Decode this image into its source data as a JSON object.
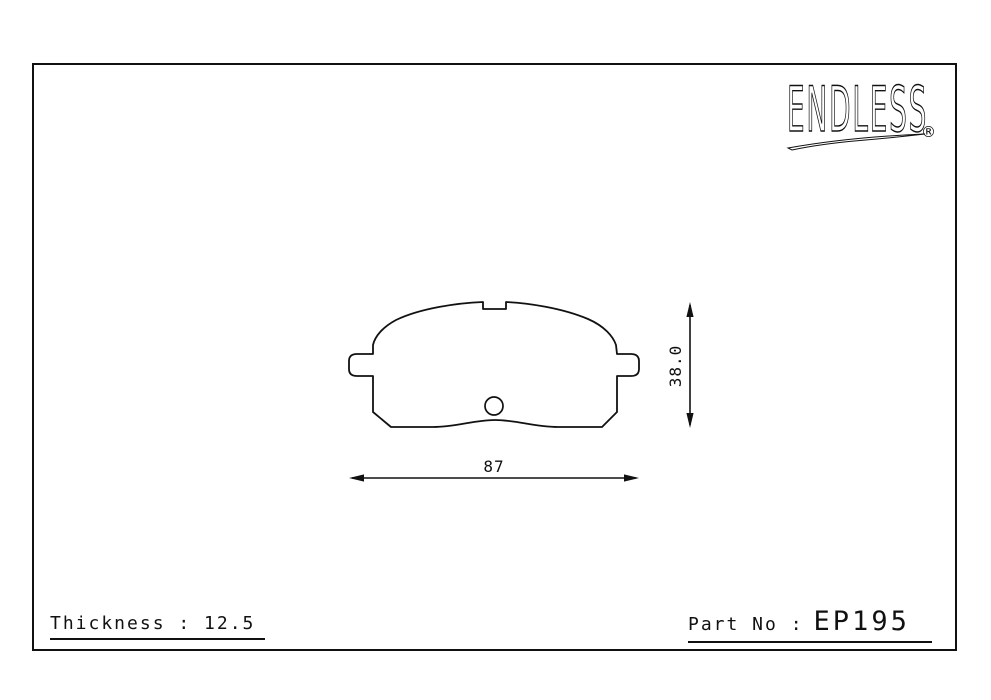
{
  "page": {
    "background": "#ffffff",
    "ink": "#111111"
  },
  "logo": {
    "brand": "ENDLESS",
    "registered": "®"
  },
  "drawing": {
    "part": "brake pad outline",
    "height_dim": "38.0",
    "width_dim": "87"
  },
  "footer": {
    "thickness": "Thickness : 12.5",
    "part_no_label": "Part No :",
    "part_no_value": "EP195"
  }
}
